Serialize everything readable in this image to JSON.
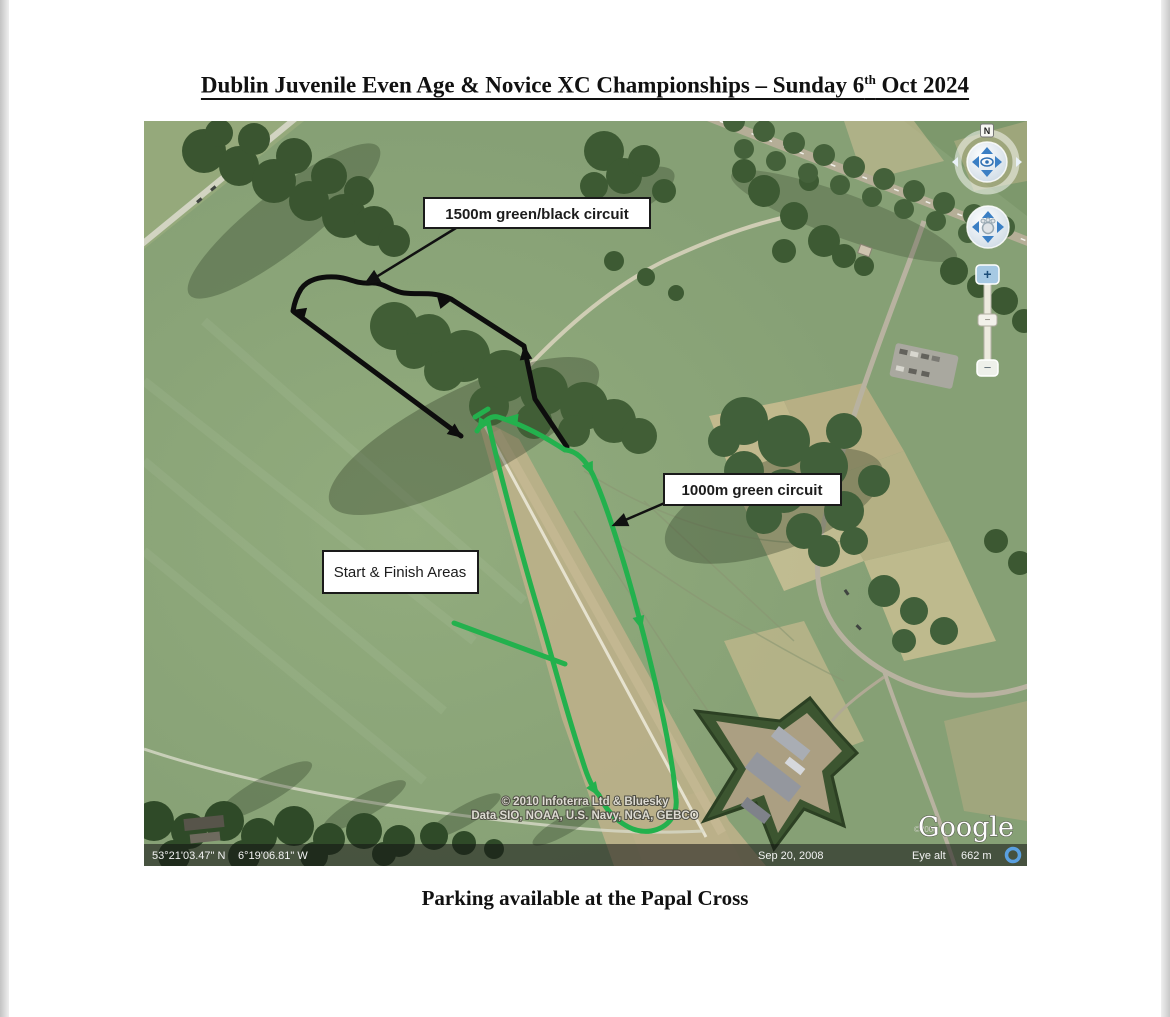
{
  "document": {
    "title_prefix": "Dublin Juvenile Even Age & Novice XC Championships – Sunday 6",
    "title_superscript": "th",
    "title_suffix": " Oct 2024",
    "caption": "Parking available at the Papal Cross"
  },
  "map": {
    "annotations": {
      "black_circuit_label": "1500m green/black circuit",
      "green_circuit_label": "1000m green circuit",
      "start_finish_label": "Start & Finish Areas"
    },
    "status_bar": {
      "latitude": "53°21'03.47\" N",
      "longitude": "6°19'06.81\" W",
      "imagery_date": "Sep 20, 2008",
      "eye_alt_label": "Eye alt",
      "eye_alt_value": "662 m"
    },
    "credits": {
      "line1": "© 2010 Infoterra Ltd & Bluesky",
      "line2": "Data SIO, NOAA, U.S. Navy, NGA, GEBCO",
      "logo": "Google",
      "logo_year": "©2008"
    },
    "controls": {
      "north_label": "N",
      "zoom_in_label": "+",
      "zoom_out_label": "−",
      "zoom_handle_label": "−"
    },
    "colors": {
      "route_green": "#23b14d",
      "route_black": "#0d0d0d"
    }
  }
}
